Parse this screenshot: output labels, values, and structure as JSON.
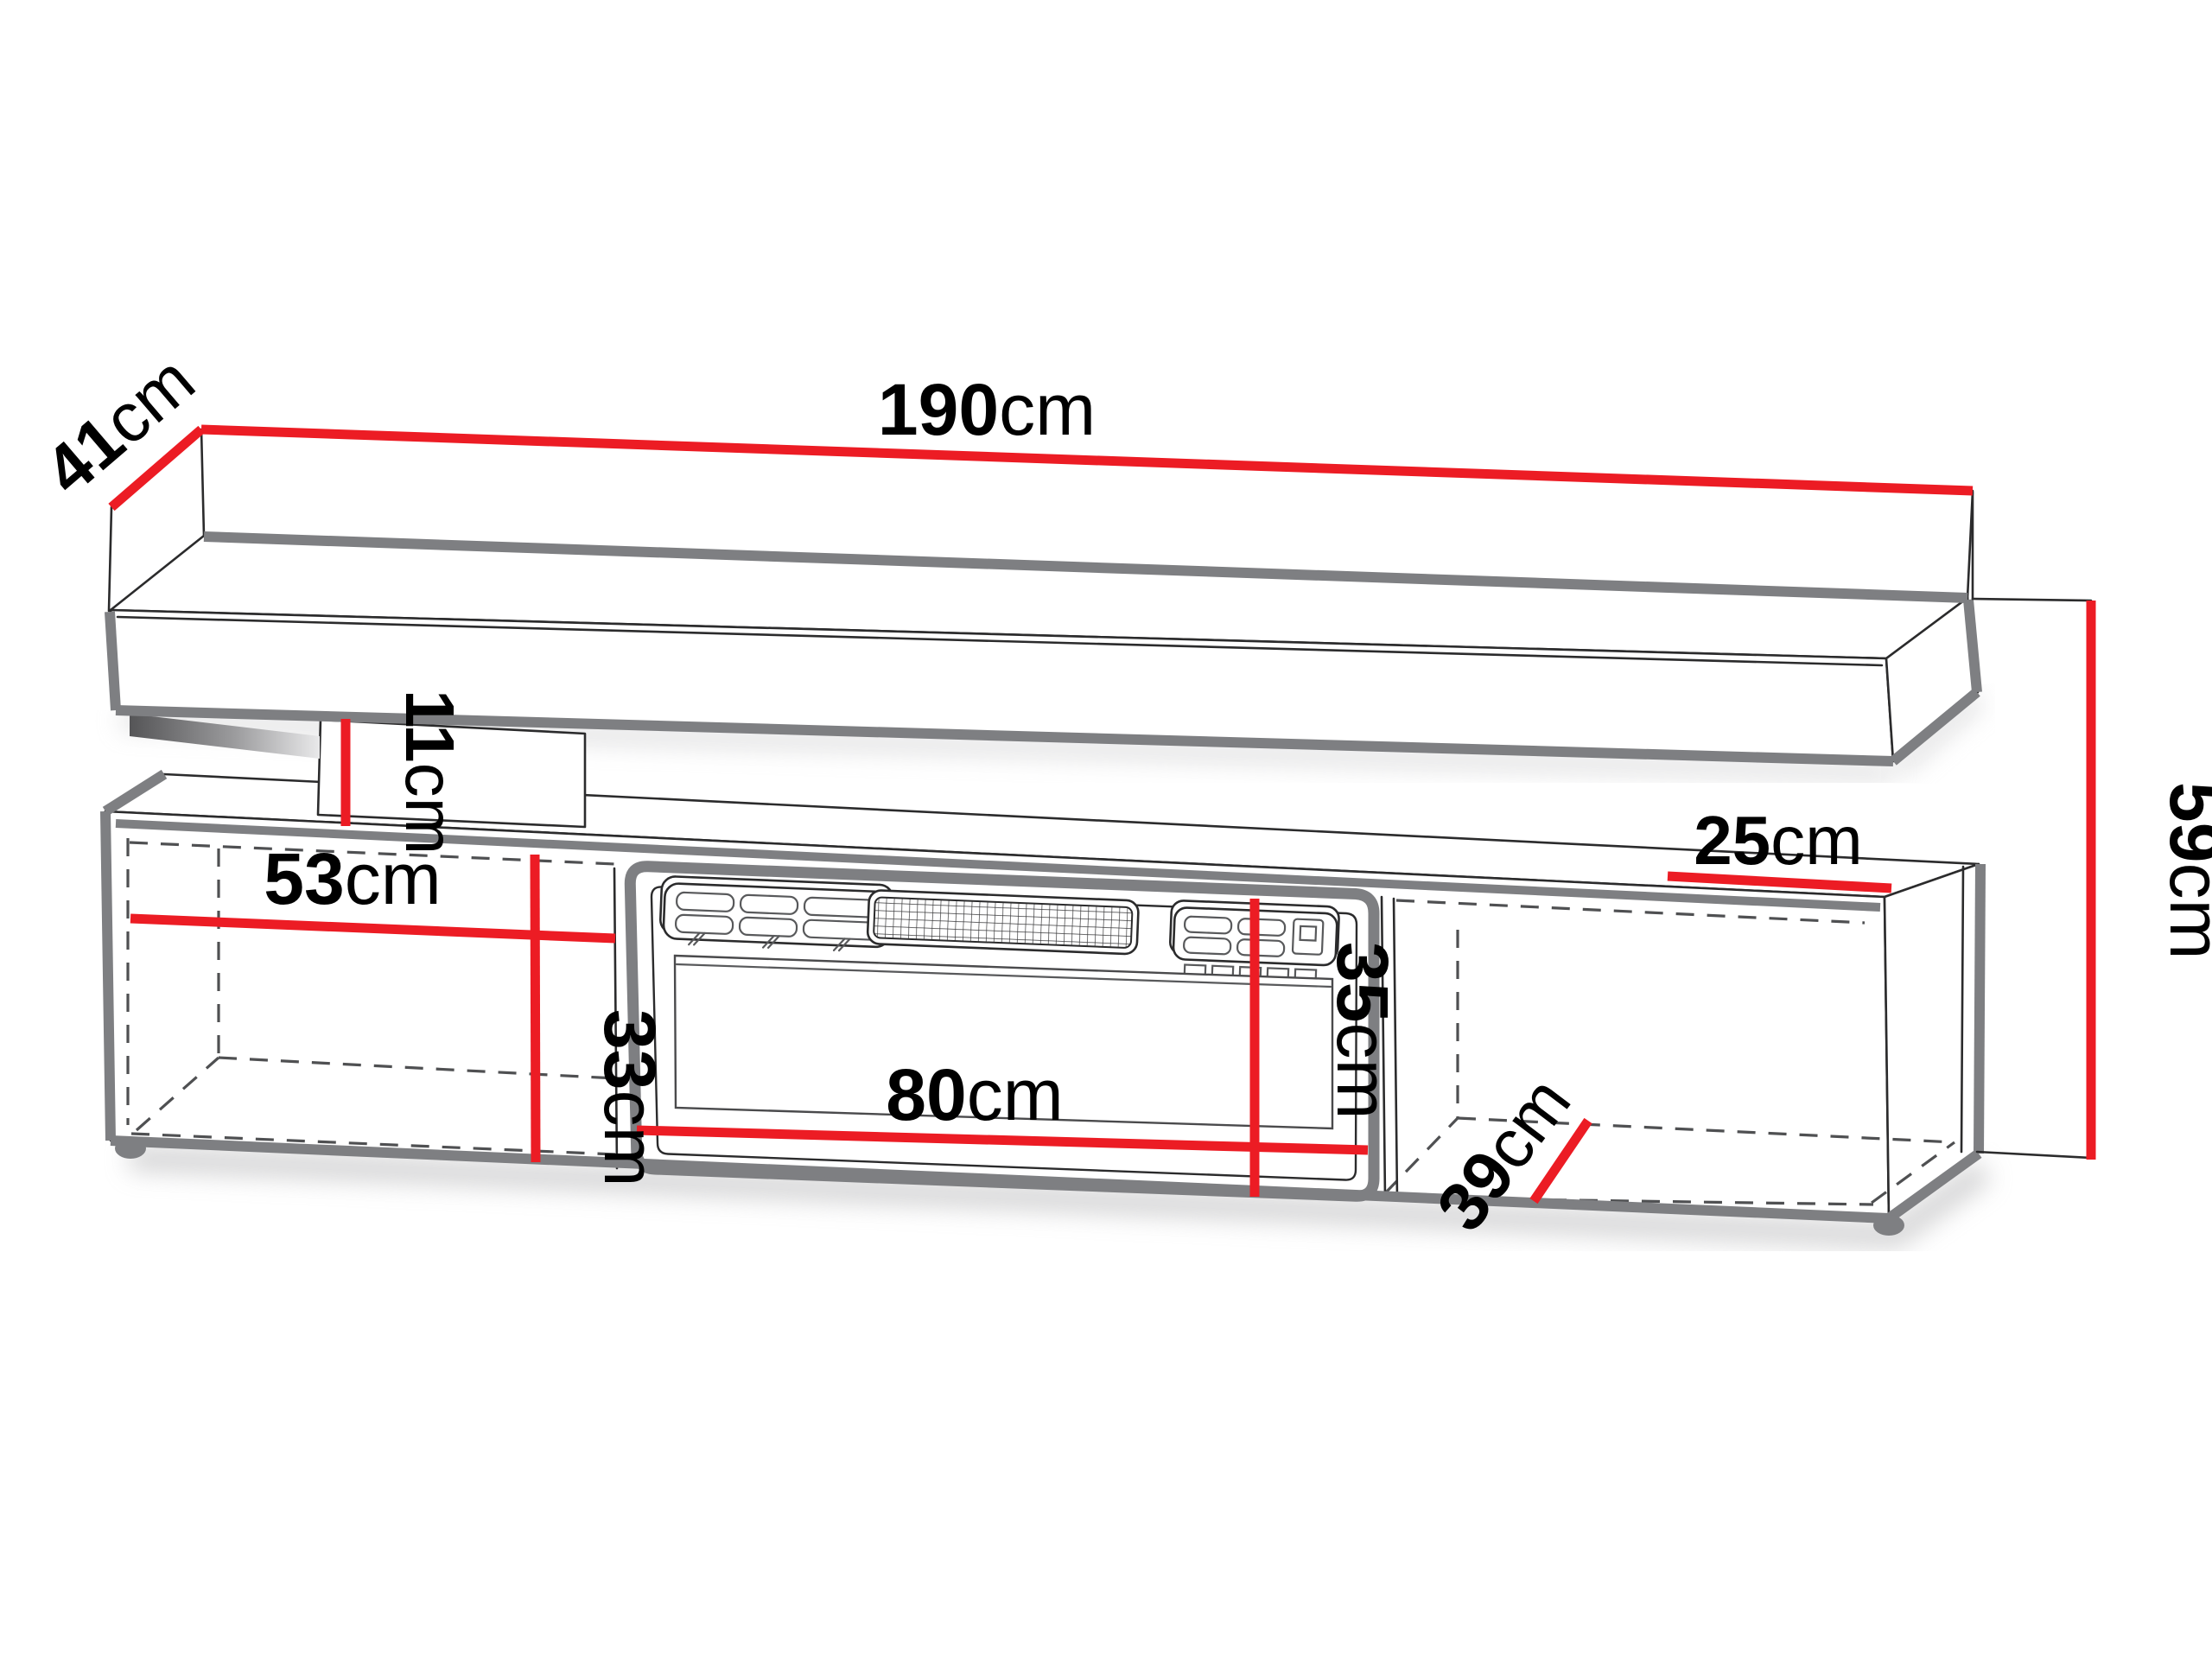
{
  "figure": {
    "kind": "furniture dimension diagram",
    "subject": "TV stand with electric fireplace and wall shelf",
    "unit": "cm",
    "accent_color": "#ec1c24",
    "outline_color": "#2b2b2c",
    "shadow_edge_color": "#7e7f82",
    "hidden_edge_style": "dashed"
  },
  "dimensions": {
    "shelf_width": {
      "value": "190",
      "unit": "cm"
    },
    "shelf_depth": {
      "value": "41",
      "unit": "cm"
    },
    "overall_height": {
      "value": "59",
      "unit": "cm"
    },
    "shelf_gap_height": {
      "value": "11",
      "unit": "cm"
    },
    "left_compartment_width": {
      "value": "53",
      "unit": "cm"
    },
    "left_compartment_height": {
      "value": "33",
      "unit": "cm"
    },
    "right_compartment_top_width": {
      "value": "25",
      "unit": "cm"
    },
    "fireplace_opening_height": {
      "value": "35",
      "unit": "cm"
    },
    "fireplace_width": {
      "value": "80",
      "unit": "cm"
    },
    "cabinet_depth": {
      "value": "39",
      "unit": "cm"
    }
  }
}
